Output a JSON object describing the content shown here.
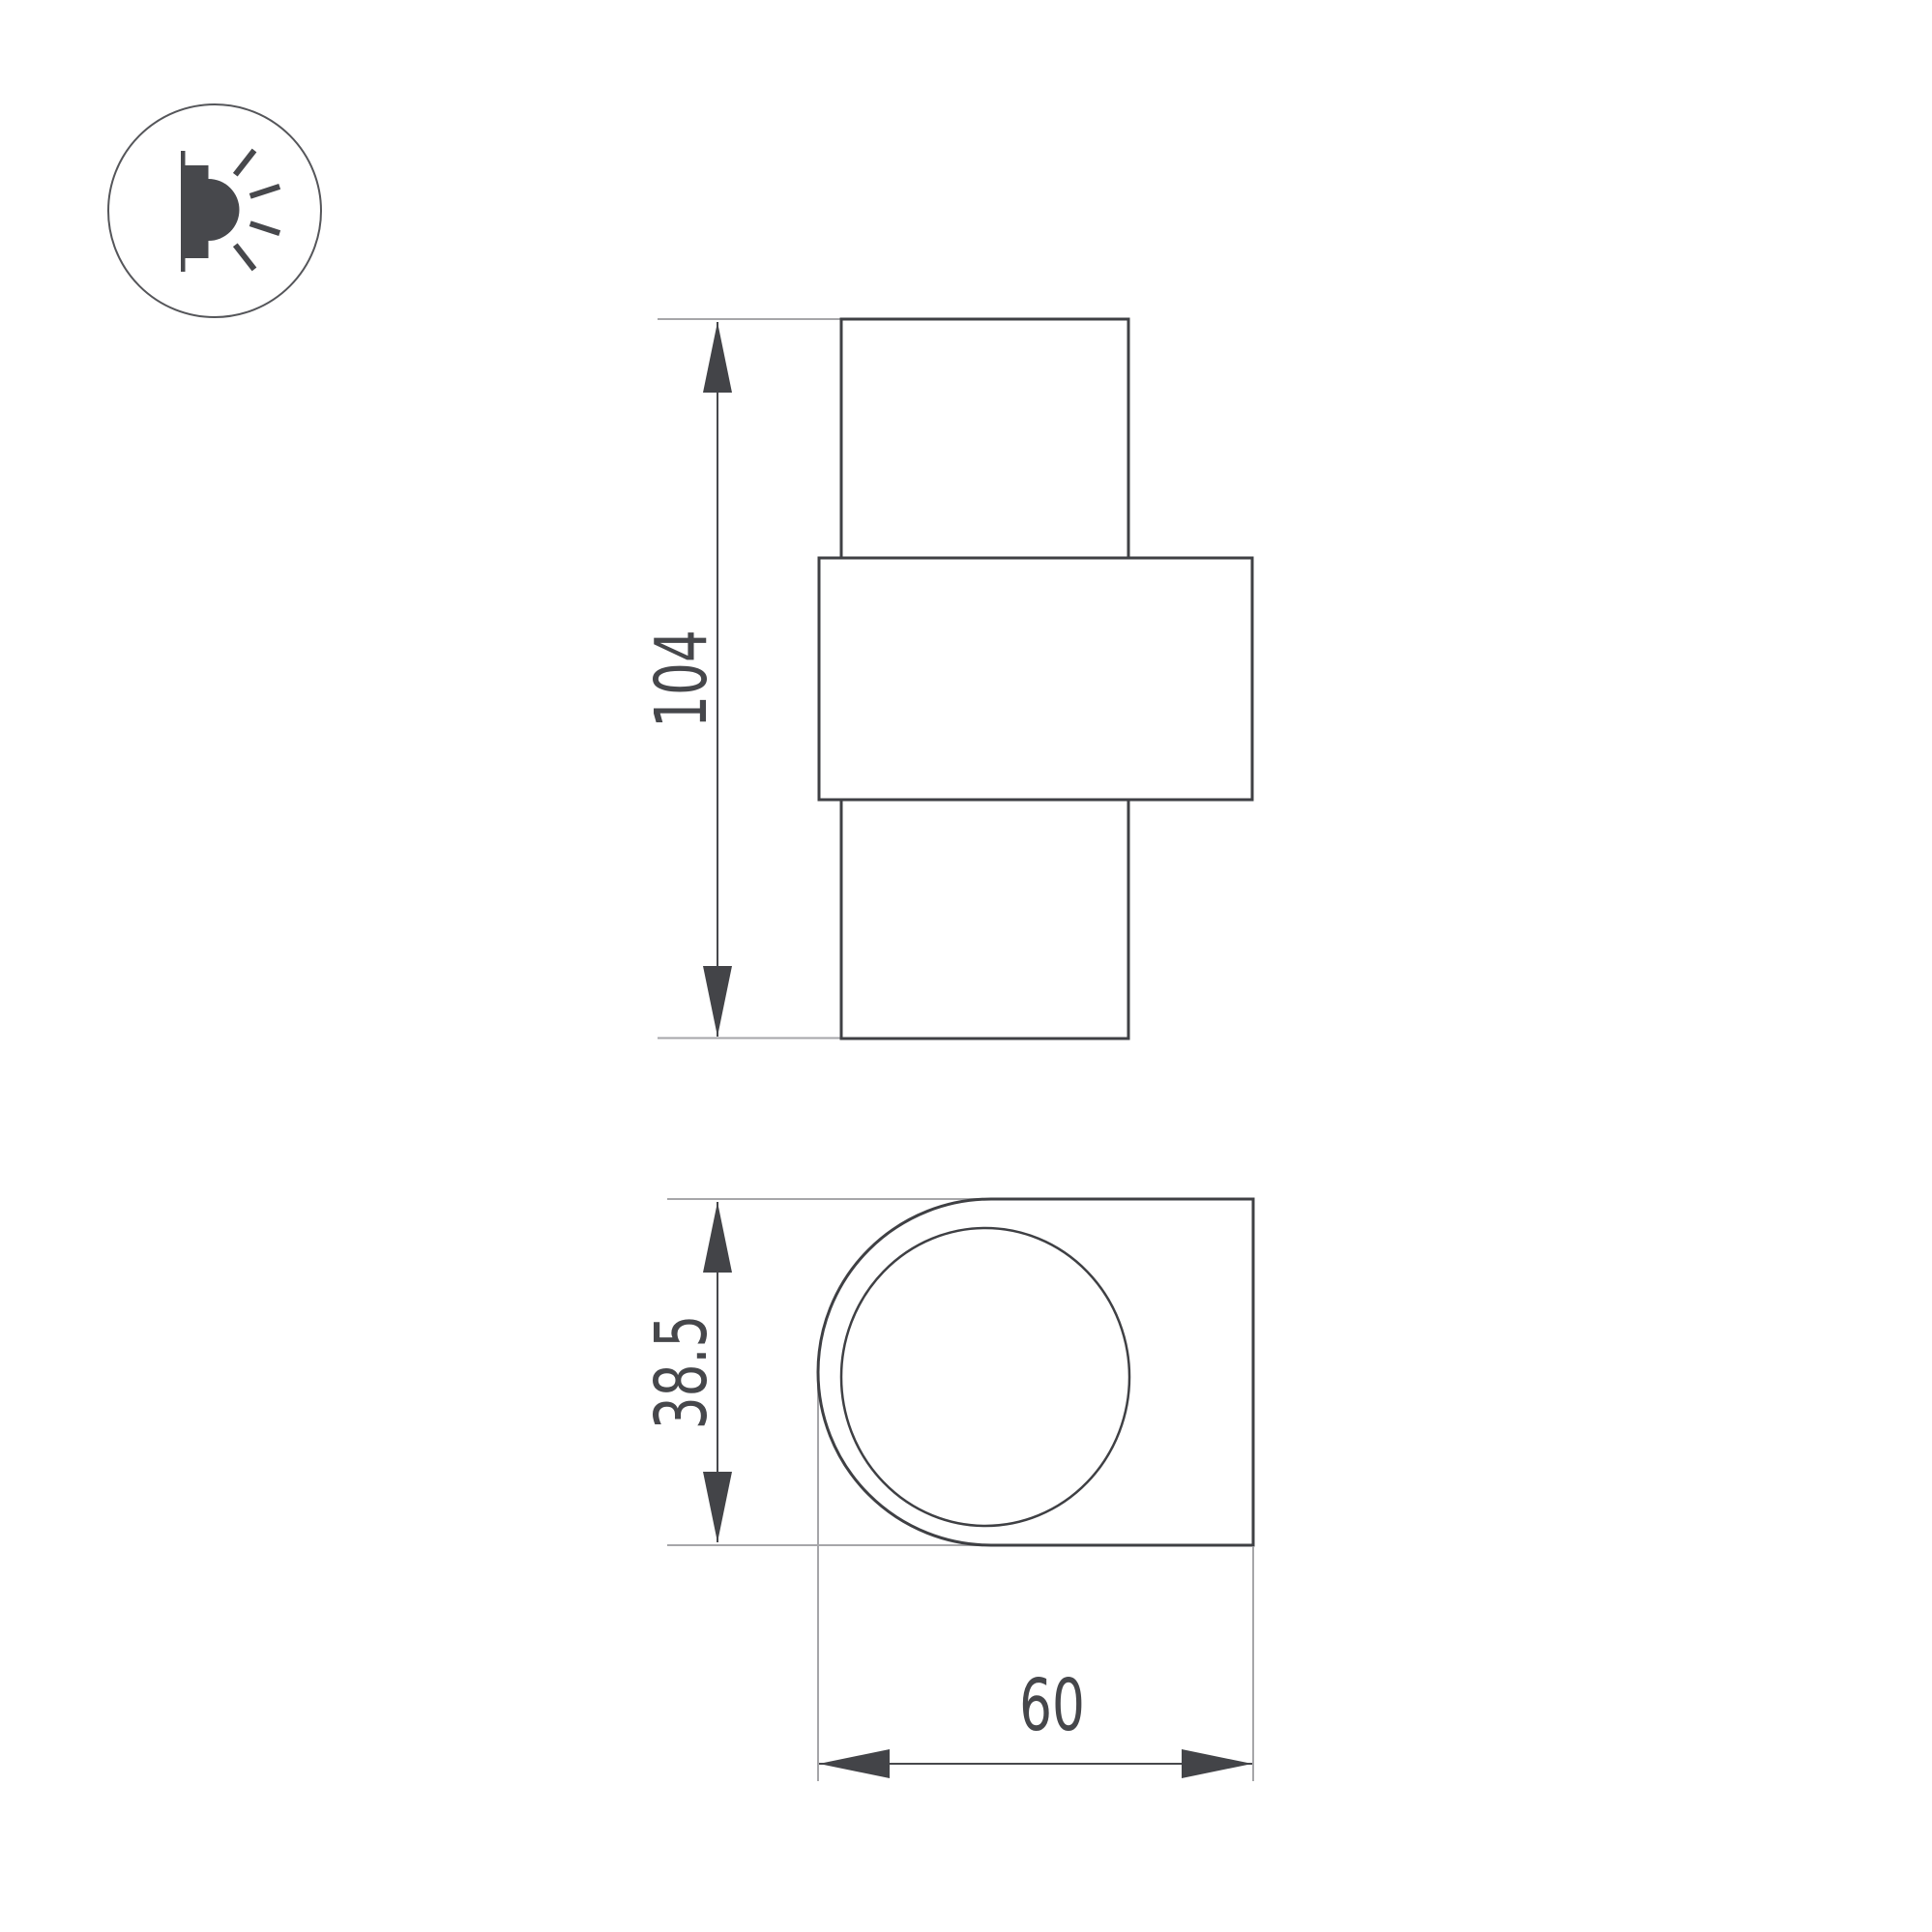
{
  "page": {
    "type": "technical dimension drawing of a wall-mounted luminaire",
    "background": "#ffffff"
  },
  "legend_icon": {
    "name": "wall-lamp-light-icon",
    "meaning": "wall-mounted light emitting sideways"
  },
  "dimensions": {
    "front_height": "104",
    "side_depth": "38.5",
    "side_width": "60"
  },
  "colors": {
    "outline": "#3f4044",
    "dimension_line": "#47484c",
    "arrow_fill": "#434448",
    "extension_line": "#a6a6a9",
    "text": "#46474b",
    "icon_fill": "#47484c",
    "icon_circle_stroke": "#55565a",
    "background": "#ffffff"
  }
}
